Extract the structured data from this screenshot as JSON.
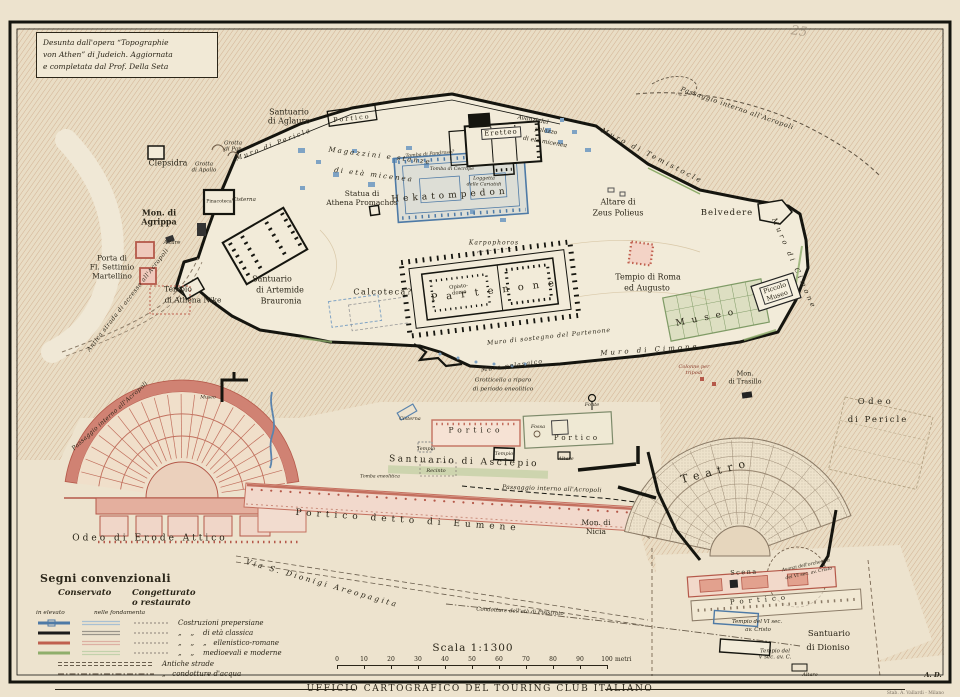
{
  "header": {
    "copyright": "PROPR. ARTISTICO-LETTERARIA DELL'ENCICLOPEDIA ITALIANA",
    "title": "L'ACROPOLI E LE SUE PENDICI",
    "attribution": "Desunta dall'opera “Topographie\nvon Athen” di Judeich. Aggiornata\ne completata dal Prof. Della Seta"
  },
  "legend": {
    "title": "Segni convenzionali",
    "col_conservato": "Conservato",
    "col_congetturato": "Congetturato\no restaurato",
    "sub_elevato": "in elevato",
    "sub_fondamenta": "nelle fondamenta",
    "rows": [
      {
        "label": "Costruzioni prepersiane",
        "color": "#4E7AA6",
        "pale": "#A9C0D2"
      },
      {
        "label": "„    „    di età classica",
        "color": "#1a1a1a",
        "pale": "#9a958a"
      },
      {
        "label": "„    „    „   ellenistico-romane",
        "color": "#C0604F",
        "pale": "#DDAFA2"
      },
      {
        "label": "„    „    medioevali e moderne",
        "color": "#8FAE6B",
        "pale": "#C2D1AB"
      }
    ],
    "antiche_strade": "Antiche strade",
    "condotture": "„   condotture d'acqua"
  },
  "scale": {
    "label": "Scala 1:1300",
    "ticks": [
      "0",
      "10",
      "20",
      "30",
      "40",
      "50",
      "60",
      "70",
      "80",
      "90",
      "100"
    ],
    "unit": "metri"
  },
  "footer": {
    "agency": "UFFICIO CARTOGRAFICO DEL TOURING CLUB ITALIANO",
    "imprint": "Stab. A. Vallardi - Milano"
  },
  "colors": {
    "paper": "#F0E8D6",
    "hatch": "#C9A07E",
    "prepersian_blue": "#4E7AA6",
    "classic_black": "#1a1a1a",
    "roman_red": "#C0604F",
    "modern_green": "#8FAE6B"
  },
  "map": {
    "labels": [
      {
        "t": "Clepsidra",
        "x": 168,
        "y": 163,
        "s": 8
      },
      {
        "t": "Grotta\ndi Pan",
        "x": 233,
        "y": 147,
        "s": 5.5,
        "i": 1
      },
      {
        "t": "Grotta\ndi Apollo",
        "x": 204,
        "y": 168,
        "s": 5.5,
        "i": 1
      },
      {
        "t": "Muro di Pericle",
        "x": 274,
        "y": 145,
        "s": 6.5,
        "i": 1,
        "r": -21,
        "ls": 2
      },
      {
        "t": "Santuario\ndi Aglauro",
        "x": 289,
        "y": 117,
        "s": 8
      },
      {
        "t": "Portico",
        "x": 352,
        "y": 119,
        "s": 6.5,
        "ls": 2,
        "r": -6
      },
      {
        "t": "Magazzini e stanze",
        "x": 380,
        "y": 156,
        "s": 7,
        "i": 1,
        "ls": 2,
        "r": 7
      },
      {
        "t": "di età micenea",
        "x": 374,
        "y": 175,
        "s": 7,
        "i": 1,
        "ls": 2,
        "r": 7
      },
      {
        "t": "Statua di\nAthena Promachos",
        "x": 362,
        "y": 199,
        "s": 7.5
      },
      {
        "t": "Eretteo",
        "x": 501,
        "y": 133,
        "s": 7,
        "ls": 1,
        "bg": 1,
        "r": -4
      },
      {
        "t": "Tomba di Pandroso?",
        "x": 430,
        "y": 155,
        "s": 4.8,
        "i": 1,
        "r": -5
      },
      {
        "t": "Tomba di Cecrope",
        "x": 452,
        "y": 170,
        "s": 4.8,
        "i": 1
      },
      {
        "t": "Loggetta\ndelle Cariatidi",
        "x": 484,
        "y": 182,
        "s": 4.8,
        "i": 1
      },
      {
        "t": "Avanzi del",
        "x": 533,
        "y": 120,
        "s": 6,
        "i": 1,
        "r": 10
      },
      {
        "t": "palazzo",
        "x": 546,
        "y": 131,
        "s": 6,
        "i": 1,
        "r": 10
      },
      {
        "t": "di età micenea",
        "x": 545,
        "y": 142,
        "s": 6,
        "i": 1,
        "r": 10
      },
      {
        "t": "Hekatompedon",
        "x": 450,
        "y": 196,
        "s": 9,
        "ls": 4,
        "r": -4
      },
      {
        "t": "Mon. di\nAgrippa",
        "x": 159,
        "y": 218,
        "s": 8,
        "b": 1
      },
      {
        "t": "Pinacoteca",
        "x": 219,
        "y": 202,
        "s": 4.6
      },
      {
        "t": "Cisterna",
        "x": 244,
        "y": 200,
        "s": 5.5,
        "i": 1
      },
      {
        "t": "Porta di\nFl. Settimio\nMartellino",
        "x": 112,
        "y": 268,
        "s": 7.5
      },
      {
        "t": "Altare",
        "x": 172,
        "y": 243,
        "s": 5.5,
        "i": 1
      },
      {
        "t": "Tempio",
        "x": 178,
        "y": 290,
        "s": 7.5
      },
      {
        "t": "di Athena Nike",
        "x": 193,
        "y": 301,
        "s": 7.5
      },
      {
        "t": "Antica strada di accesso all'Acropoli",
        "x": 128,
        "y": 300,
        "s": 6,
        "i": 1,
        "ls": 0.5,
        "r": -52
      },
      {
        "t": "Santuario",
        "x": 272,
        "y": 279,
        "s": 8
      },
      {
        "t": "di Artemide",
        "x": 280,
        "y": 290,
        "s": 8
      },
      {
        "t": "Brauronia",
        "x": 281,
        "y": 301,
        "s": 8
      },
      {
        "t": "Calcoteca?",
        "x": 383,
        "y": 292,
        "s": 8,
        "ls": 1.5
      },
      {
        "t": "Karpophoros",
        "x": 494,
        "y": 243,
        "s": 6,
        "i": 1,
        "ls": 1
      },
      {
        "t": "Partenone",
        "x": 497,
        "y": 291,
        "s": 10,
        "ls": 9,
        "r": -7
      },
      {
        "t": "Opisto-\ndomo",
        "x": 459,
        "y": 290,
        "s": 5.2,
        "r": -7
      },
      {
        "t": "Muro di sostegno del Partenone",
        "x": 549,
        "y": 337,
        "s": 6.2,
        "i": 1,
        "ls": 0.8,
        "r": -6
      },
      {
        "t": "Muro pelasgico",
        "x": 512,
        "y": 366,
        "s": 6.2,
        "i": 1,
        "ls": 1,
        "r": -8
      },
      {
        "t": "Grotticella a riparo",
        "x": 503,
        "y": 381,
        "s": 5.8,
        "i": 1
      },
      {
        "t": "di periodo eneolitico",
        "x": 503,
        "y": 390,
        "s": 5.8,
        "i": 1
      },
      {
        "t": "Tempio di Roma",
        "x": 648,
        "y": 277,
        "s": 8
      },
      {
        "t": "ed Augusto",
        "x": 647,
        "y": 288,
        "s": 8
      },
      {
        "t": "Altare di",
        "x": 618,
        "y": 202,
        "s": 8
      },
      {
        "t": "Zeus Polieus",
        "x": 618,
        "y": 213,
        "s": 8
      },
      {
        "t": "Belvedere",
        "x": 727,
        "y": 213,
        "s": 8.5,
        "ls": 1
      },
      {
        "t": "Muro di Cimone",
        "x": 650,
        "y": 350,
        "s": 7,
        "i": 1,
        "ls": 3,
        "r": -4
      },
      {
        "t": "Muro di Cimone",
        "x": 794,
        "y": 264,
        "s": 7,
        "i": 1,
        "ls": 3,
        "r": 66
      },
      {
        "t": "Muro di Temistocle",
        "x": 652,
        "y": 156,
        "s": 7,
        "i": 1,
        "ls": 2.5,
        "r": 27
      },
      {
        "t": "Passaggio interno all'Acropoli",
        "x": 737,
        "y": 109,
        "s": 6.5,
        "i": 1,
        "ls": 0.7,
        "r": 19
      },
      {
        "t": "Museo",
        "x": 708,
        "y": 318,
        "s": 9,
        "ls": 7,
        "r": -11
      },
      {
        "t": "Piccolo\nMuseo",
        "x": 776,
        "y": 292,
        "s": 6.5,
        "r": -18,
        "bg": 1
      },
      {
        "t": "Odeo",
        "x": 876,
        "y": 402,
        "s": 8.5,
        "ls": 3.5
      },
      {
        "t": "di Pericle",
        "x": 878,
        "y": 420,
        "s": 8.5,
        "ls": 2
      },
      {
        "t": "Colonne per\ntripodi",
        "x": 694,
        "y": 371,
        "s": 5,
        "i": 1,
        "c": "#8a3a2a"
      },
      {
        "t": "Mon.\ndi Trasillo",
        "x": 745,
        "y": 378,
        "s": 6.5
      },
      {
        "t": "Teatro",
        "x": 716,
        "y": 472,
        "s": 11,
        "ls": 6,
        "r": -14
      },
      {
        "t": "Scena",
        "x": 744,
        "y": 573,
        "s": 6.5,
        "ls": 1.5,
        "r": -3
      },
      {
        "t": "Portico",
        "x": 760,
        "y": 600,
        "s": 7,
        "ls": 5,
        "r": -5
      },
      {
        "t": "Avanzi dell'orchestra",
        "x": 806,
        "y": 566,
        "s": 4.6,
        "i": 1,
        "r": -12
      },
      {
        "t": "del VI sec. av. Cristo",
        "x": 809,
        "y": 574,
        "s": 4.6,
        "i": 1,
        "r": -12
      },
      {
        "t": "Tempio del VI sec.",
        "x": 757,
        "y": 622,
        "s": 5.4,
        "i": 1
      },
      {
        "t": "av. Cristo",
        "x": 758,
        "y": 630,
        "s": 5.4,
        "i": 1
      },
      {
        "t": "Tempio del\nV sec. av. C.",
        "x": 775,
        "y": 655,
        "s": 5.4,
        "i": 1
      },
      {
        "t": "Santuario",
        "x": 829,
        "y": 634,
        "s": 8.5
      },
      {
        "t": "di Dioniso",
        "x": 828,
        "y": 648,
        "s": 8.5
      },
      {
        "t": "Altare",
        "x": 810,
        "y": 676,
        "s": 5,
        "i": 1
      },
      {
        "t": "Mon. di\nNicia",
        "x": 596,
        "y": 528,
        "s": 7.5
      },
      {
        "t": "Santuario di Asclepio",
        "x": 464,
        "y": 462,
        "s": 9,
        "ls": 2.5,
        "r": 2
      },
      {
        "t": "Portico",
        "x": 476,
        "y": 431,
        "s": 7.5,
        "ls": 4
      },
      {
        "t": "Portico",
        "x": 577,
        "y": 438,
        "s": 7,
        "ls": 3
      },
      {
        "t": "Fonte",
        "x": 592,
        "y": 406,
        "s": 5,
        "i": 1
      },
      {
        "t": "Fossa",
        "x": 538,
        "y": 428,
        "s": 5,
        "i": 1
      },
      {
        "t": "Cisterna",
        "x": 410,
        "y": 420,
        "s": 5,
        "i": 1
      },
      {
        "t": "Tempio",
        "x": 426,
        "y": 450,
        "s": 5,
        "i": 1
      },
      {
        "t": "Tempio",
        "x": 504,
        "y": 455,
        "s": 5,
        "i": 1
      },
      {
        "t": "Altare",
        "x": 566,
        "y": 460,
        "s": 5,
        "i": 1
      },
      {
        "t": "Recinto",
        "x": 436,
        "y": 472,
        "s": 5,
        "i": 1
      },
      {
        "t": "Tomba eneolitica",
        "x": 380,
        "y": 477,
        "s": 4.6,
        "i": 1
      },
      {
        "t": "Passaggio interno all'Acropoli",
        "x": 552,
        "y": 489,
        "s": 6,
        "i": 1,
        "ls": 0.3,
        "r": 2
      },
      {
        "t": "Odeo di Erode Attico",
        "x": 150,
        "y": 539,
        "s": 9,
        "ls": 3
      },
      {
        "t": "Passaggio interno all'Acropoli",
        "x": 110,
        "y": 416,
        "s": 6,
        "i": 1,
        "ls": 0.3,
        "r": -42
      },
      {
        "t": "Museo",
        "x": 208,
        "y": 398,
        "s": 4.6,
        "i": 1
      },
      {
        "t": "Portico detto di Eumene",
        "x": 408,
        "y": 521,
        "s": 9,
        "ls": 5,
        "r": 4
      },
      {
        "t": "Via S. Dionigi Areopagita",
        "x": 322,
        "y": 584,
        "s": 7.5,
        "i": 1,
        "ls": 2.5,
        "r": 16
      },
      {
        "t": "Condotture dell'età di Pisistrato",
        "x": 520,
        "y": 612,
        "s": 5.4,
        "i": 1,
        "r": 3
      },
      {
        "t": "A. D.",
        "x": 933,
        "y": 676,
        "s": 6.5,
        "i": 1,
        "b": 1
      },
      {
        "t": "25",
        "x": 799,
        "y": 32,
        "s": 13,
        "i": 1,
        "r": 8,
        "c": "rgba(115,98,80,0.45)"
      }
    ]
  }
}
